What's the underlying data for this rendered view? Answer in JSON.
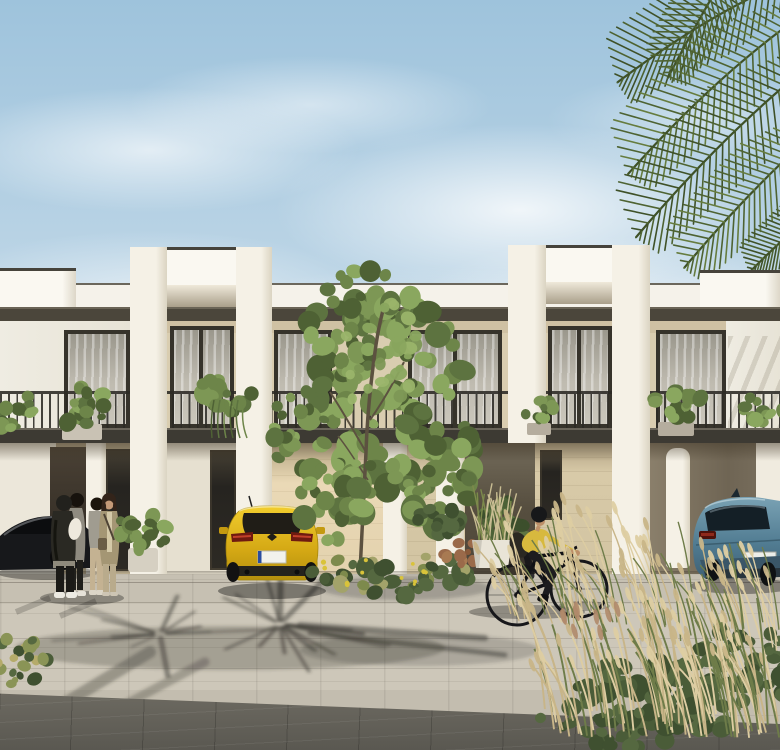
{
  "scene": {
    "labels": {
      "scene": "Photorealistic rendering of a row of modern two-storey townhouses with palm trees, pedestrians, a cyclist and parked cars",
      "sky": "Blue sky with wispy white clouds",
      "palm_fronds": "Palm fronds overhanging from the top right corner",
      "townhouses": "White and beige modern townhouses with protruding white portal frames",
      "balcony_railing": "Continuous black metal balcony railing on the first floor",
      "balcony_plants": "Potted green plants on the balconies",
      "pedestrians": "Four people standing and talking on the sidewalk",
      "black_car": "Dark sports car parked at the far left",
      "yellow_car": "Yellow hot-hatchback parked in a driveway, seen from the rear",
      "blue_suv": "Blue SUV parked under the carport on the right",
      "cyclist": "Cyclist in a yellow shirt and black helmet riding past",
      "tree": "Tall leafy green tree in front of the facade",
      "ground_plants": "Planters, ferns and flowering shrubs at street level",
      "grasses": "Tan ornamental grasses and green bushes in the foreground",
      "pavement": "Light paved plaza crossed by palm-tree shadows",
      "dark_pavers": "Dark grey paver strip in the immediate foreground",
      "license_plate": "Blank license plate",
      "windows": "Full-height dark-framed windows with sheer curtains"
    }
  },
  "palette": {
    "sky_top": "#9ec3dc",
    "sky_mid": "#c3d9e8",
    "sky_horizon": "#e6eef3",
    "cloud": "#ffffff",
    "palm_dark": "#3f5128",
    "palm_mid": "#4e6332",
    "palm_light": "#667c3e",
    "wall_white": "#f5f2ea",
    "wall_white_bright": "#faf8f1",
    "fascia": "#4b463b",
    "frieze": "#cfc1a3",
    "beige_wall": "#d9cdb0",
    "stone_wall": "#d8caa8",
    "window_frame": "#36332b",
    "slab": "#3d3a33",
    "railing": "#2c2a25",
    "shadow": "#3a3830",
    "tree_greens": [
      "#4e6134",
      "#5d7340",
      "#6d8549",
      "#7d9755",
      "#8aa75f"
    ],
    "bush_greens": [
      "#3f5030",
      "#4a5c38",
      "#556840"
    ],
    "grass_tan": "#c8b588",
    "grass_tan_light": "#ddcda2",
    "grass_green": "#6e7c49",
    "grass_red": "#b08a6a",
    "car_yellow": "#e8c120",
    "car_blue": "#6794a9",
    "car_black": "#17181b",
    "jersey": "#d7b93e",
    "helmet": "#17181a",
    "skin": "#bd8f68",
    "pot_white": "#e9e4d7"
  }
}
